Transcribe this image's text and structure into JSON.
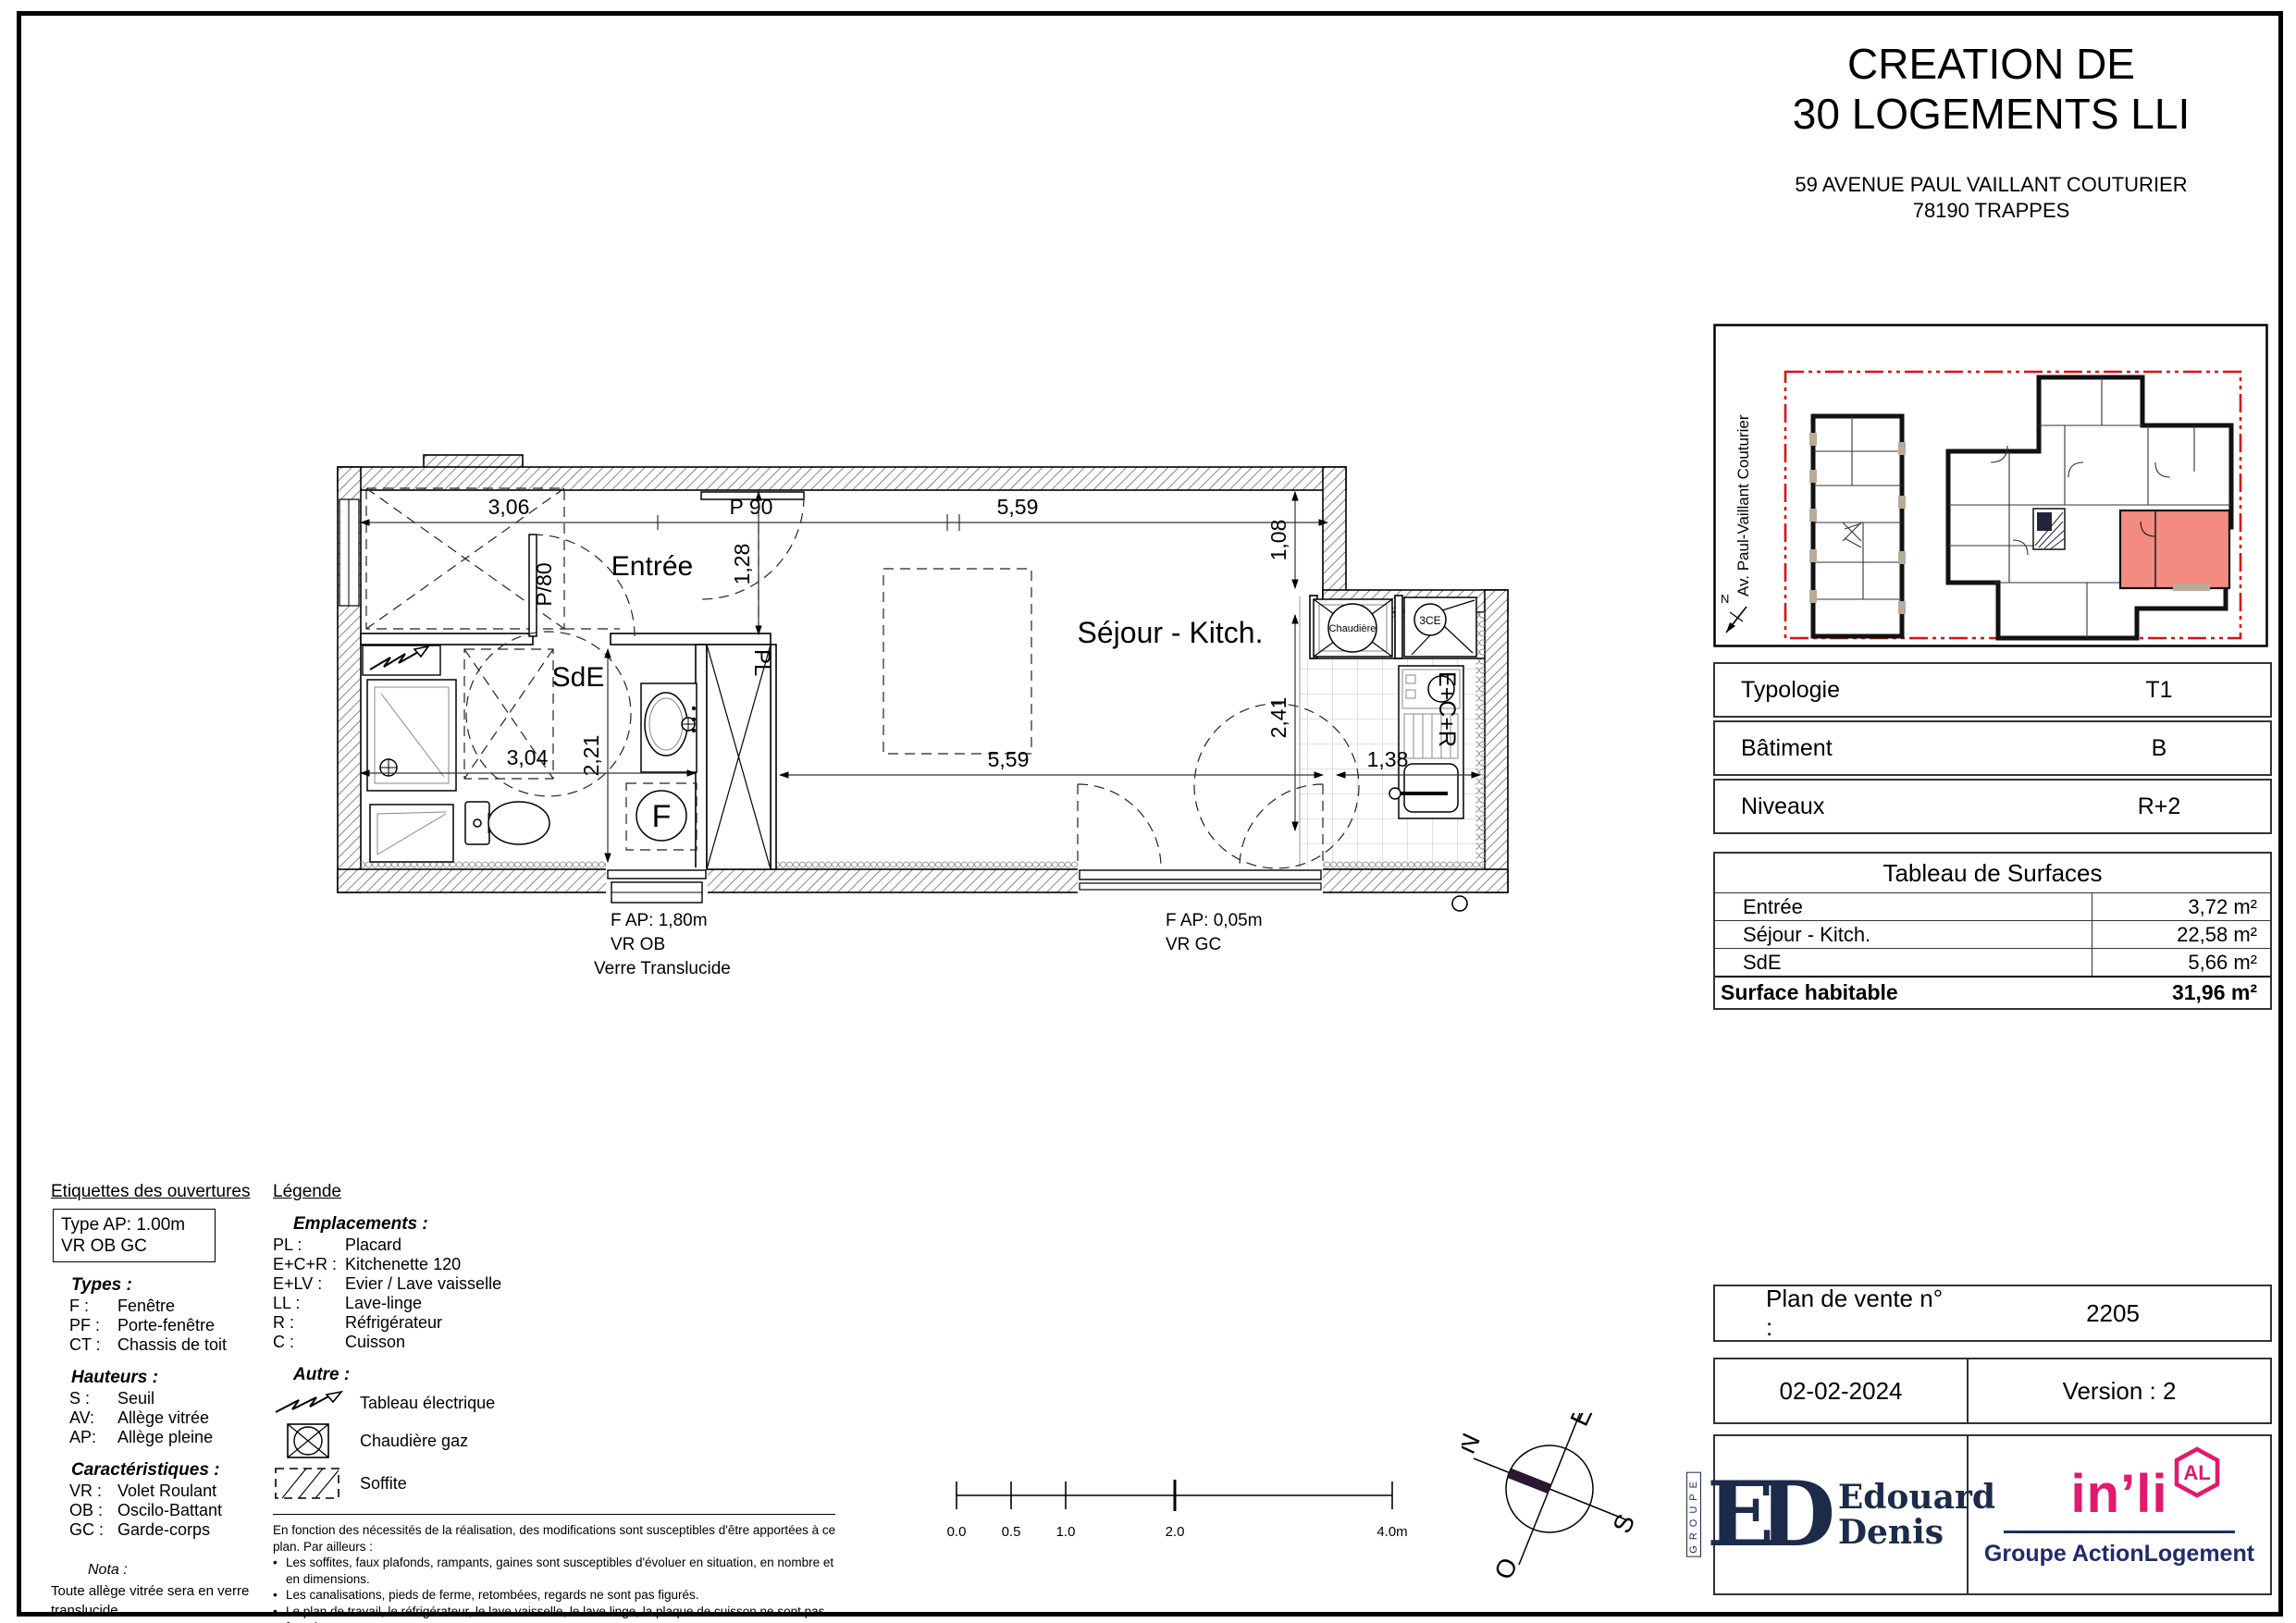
{
  "title": {
    "line1": "CREATION DE",
    "line2": "30 LOGEMENTS LLI",
    "address1": "59 AVENUE PAUL VAILLANT COUTURIER",
    "address2": "78190 TRAPPES"
  },
  "site_plan": {
    "street": "Av. Paul-Vaillant Couturier",
    "north_label": "N",
    "highlight_color": "#f28b80",
    "boundary_color": "#dd1111"
  },
  "info_table": {
    "rows": [
      {
        "label": "Typologie",
        "value": "T1"
      },
      {
        "label": "Bâtiment",
        "value": "B"
      },
      {
        "label": "Niveaux",
        "value": "R+2"
      }
    ]
  },
  "surfaces": {
    "title": "Tableau de Surfaces",
    "rows": [
      {
        "label": "Entrée",
        "value": "3,72 m²"
      },
      {
        "label": "Séjour - Kitch.",
        "value": "22,58 m²"
      },
      {
        "label": "SdE",
        "value": "5,66 m²"
      }
    ],
    "total_label": "Surface habitable",
    "total_value": "31,96 m²"
  },
  "plan_vente": {
    "label": "Plan de vente n° :",
    "number": "2205",
    "date": "02-02-2024",
    "version": "Version :  2"
  },
  "logos": {
    "groupe": "GROUPE",
    "monogram": "ED",
    "name1": "Edouard",
    "name2": "Denis",
    "inli": "in’li",
    "al_badge": "AL",
    "action": "Groupe ActionLogement"
  },
  "floor_plan": {
    "rooms": {
      "entree": "Entrée",
      "sde": "SdE",
      "sejour": "Séjour - Kitch."
    },
    "dims": {
      "d306": "3,06",
      "p90": "P 90",
      "d559top": "5,59",
      "d128": "1,28",
      "p80": "P/80",
      "d221": "2,21",
      "d304": "3,04",
      "d559": "5,59",
      "d108": "1,08",
      "d241": "2,41",
      "d138": "1,38"
    },
    "fixtures": {
      "pl": "PL",
      "chaudiere": "Chaudière",
      "flue": "3CE",
      "kitchenette": "E+C+R",
      "window_tag": "F"
    },
    "window1": [
      "F   AP: 1,80m",
      "VR   OB",
      "Verre Translucide"
    ],
    "window2": [
      "F   AP: 0,05m",
      "VR   GC"
    ]
  },
  "legend_openings": {
    "heading": "Etiquettes des ouvertures",
    "tag_line1": "Type   AP: 1.00m",
    "tag_line2": "VR   OB   GC",
    "types_heading": "Types :",
    "types": [
      [
        "F :",
        "Fenêtre"
      ],
      [
        "PF :",
        "Porte-fenêtre"
      ],
      [
        "CT :",
        "Chassis de toit"
      ]
    ],
    "heights_heading": "Hauteurs :",
    "heights": [
      [
        "S :",
        "Seuil"
      ],
      [
        "AV:",
        "Allège vitrée"
      ],
      [
        "AP:",
        "Allège pleine"
      ]
    ],
    "chars_heading": "Caractéristiques :",
    "chars": [
      [
        "VR :",
        "Volet Roulant"
      ],
      [
        "OB :",
        "Oscilo-Battant"
      ],
      [
        "GC :",
        "Garde-corps"
      ]
    ],
    "nota_heading": "Nota :",
    "nota": "Toute allège vitrée sera en verre translucide"
  },
  "legend_main": {
    "heading": "Légende",
    "emplacements_heading": "Emplacements :",
    "emplacements": [
      [
        "PL :",
        "Placard"
      ],
      [
        "E+C+R :",
        "Kitchenette 120"
      ],
      [
        "E+LV :",
        "Evier / Lave vaisselle"
      ],
      [
        "LL :",
        "Lave-linge"
      ],
      [
        "R :",
        "Réfrigérateur"
      ],
      [
        "C :",
        "Cuisson"
      ]
    ],
    "autre_heading": "Autre :",
    "autre": [
      {
        "icon": "electrical-panel-icon",
        "label": "Tableau électrique"
      },
      {
        "icon": "gas-boiler-icon",
        "label": "Chaudière gaz"
      },
      {
        "icon": "soffit-icon",
        "label": "Soffite"
      }
    ]
  },
  "disclaimer": {
    "intro": "En fonction des nécessités de la réalisation, des modifications sont susceptibles d'être apportées à ce plan. Par ailleurs :",
    "bullets": [
      "Les soffites, faux plafonds, rampants, gaines sont susceptibles d'évoluer en situation, en nombre et en dimensions.",
      "Les canalisations, pieds de ferme, retombées, regards ne sont pas figurés.",
      "Le plan de travail, le réfrigérateur, le lave vaisselle, le lave linge, la plaque de cuisson ne sont pas fournis."
    ],
    "last": "Leur emplacement définit l'implantation des alimentations et les évacuations d'eau ainsi que l'implantation électrique."
  },
  "scalebar": {
    "ticks": [
      "0.0",
      "0.5",
      "1.0",
      "2.0",
      "4.0m"
    ]
  },
  "compass": {
    "n": "N",
    "e": "E",
    "s": "S",
    "o": "O"
  }
}
